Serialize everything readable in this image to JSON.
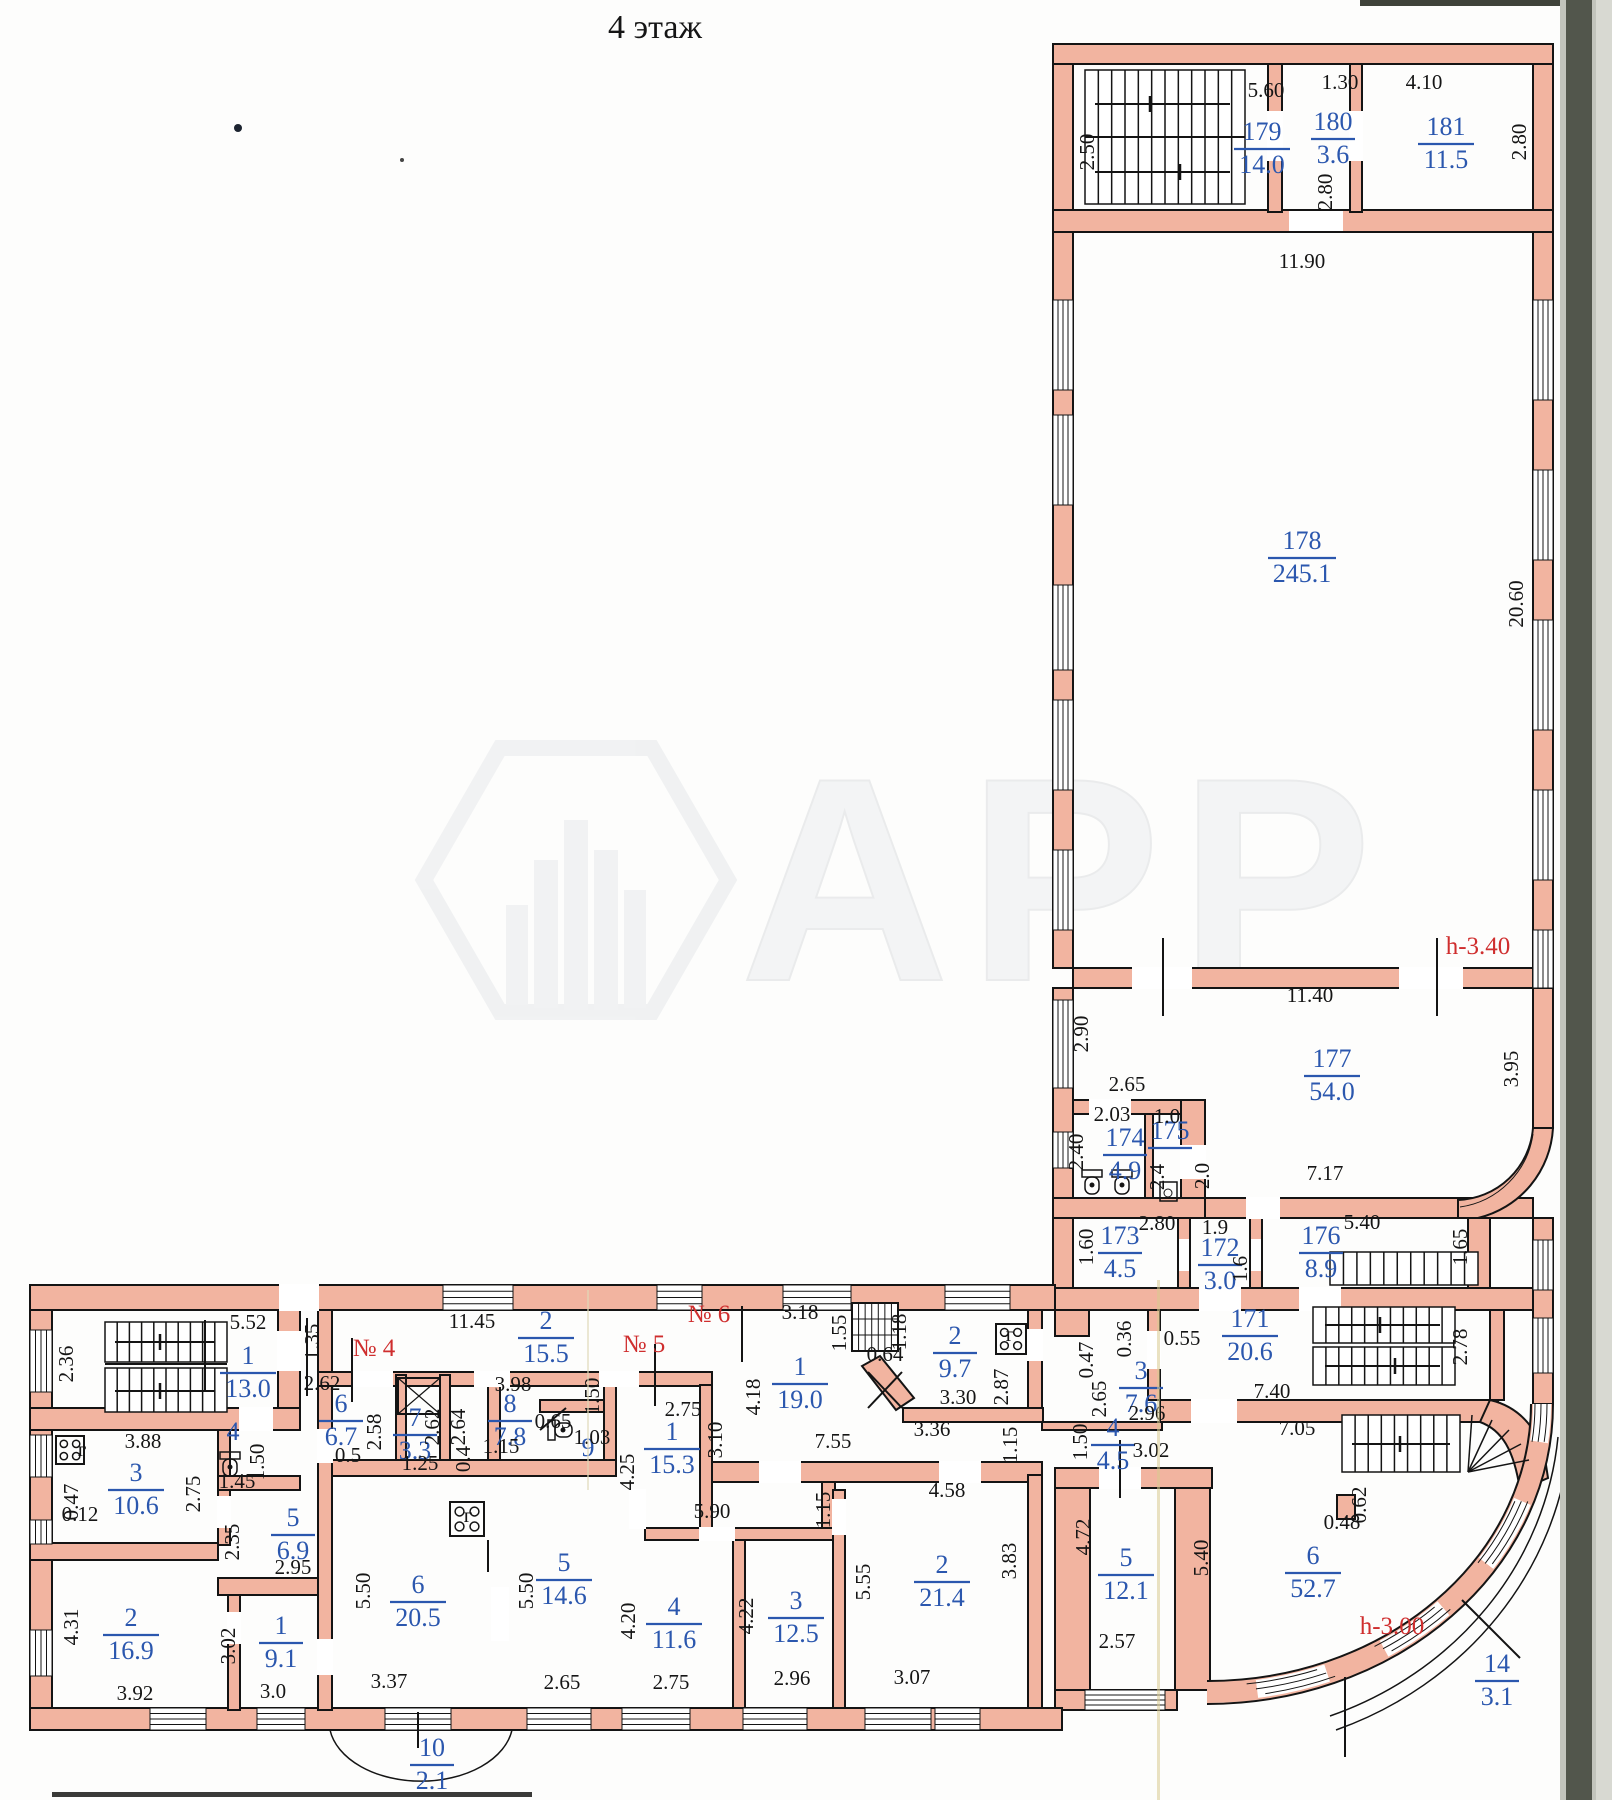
{
  "title": "4    этаж",
  "watermark": "АРР",
  "colors": {
    "wall_pink": "#f2b4a0",
    "wall_pink_light": "#f6c4b2",
    "line_black": "#141414",
    "room_blue": "#2b57ae",
    "annotation_red": "#cf2e2e",
    "scan_band_outer": "#c2c4bc",
    "scan_band_dark": "#52564c",
    "scan_band_edge": "#d8d9d2",
    "crease_yellow": "#d9cb90"
  },
  "rooms": [
    {
      "n": "179",
      "a": "14.0",
      "x": 1262,
      "y": 148
    },
    {
      "n": "180",
      "a": "3.6",
      "x": 1333,
      "y": 138
    },
    {
      "n": "181",
      "a": "11.5",
      "x": 1446,
      "y": 143
    },
    {
      "n": "178",
      "a": "245.1",
      "x": 1302,
      "y": 557
    },
    {
      "n": "177",
      "a": "54.0",
      "x": 1332,
      "y": 1075
    },
    {
      "n": "174",
      "a": "4.9",
      "x": 1125,
      "y": 1154
    },
    {
      "n": "175",
      "a": null,
      "x": 1170,
      "y": 1147
    },
    {
      "n": "173",
      "a": "4.5",
      "x": 1120,
      "y": 1252
    },
    {
      "n": "172",
      "a": "3.0",
      "x": 1220,
      "y": 1264
    },
    {
      "n": "176",
      "a": "8.9",
      "x": 1321,
      "y": 1252
    },
    {
      "n": "171",
      "a": "20.6",
      "x": 1250,
      "y": 1335
    },
    {
      "n": "3",
      "a": "7.6",
      "x": 1141,
      "y": 1387
    },
    {
      "n": "4",
      "a": "4.5",
      "x": 1113,
      "y": 1444
    },
    {
      "n": "1",
      "a": "13.0",
      "x": 248,
      "y": 1372
    },
    {
      "n": "2",
      "a": "15.5",
      "x": 546,
      "y": 1337
    },
    {
      "n": "6",
      "a": "6.7",
      "x": 341,
      "y": 1420
    },
    {
      "n": "7",
      "a": "3.3",
      "x": 415,
      "y": 1434
    },
    {
      "n": "8",
      "a": "7.8",
      "x": 510,
      "y": 1420
    },
    {
      "n": "9",
      "a": null,
      "x": 588,
      "y": 1464,
      "bar": false
    },
    {
      "n": "1",
      "a": "15.3",
      "x": 672,
      "y": 1448
    },
    {
      "n": "1",
      "a": "19.0",
      "x": 800,
      "y": 1383
    },
    {
      "n": "2",
      "a": "9.7",
      "x": 955,
      "y": 1352
    },
    {
      "n": "3",
      "a": "10.6",
      "x": 136,
      "y": 1489
    },
    {
      "n": "4",
      "a": null,
      "x": 233,
      "y": 1448,
      "bar": false
    },
    {
      "n": "5",
      "a": "6.9",
      "x": 293,
      "y": 1534
    },
    {
      "n": "2",
      "a": "16.9",
      "x": 131,
      "y": 1634
    },
    {
      "n": "1",
      "a": "9.1",
      "x": 281,
      "y": 1642
    },
    {
      "n": "6",
      "a": "20.5",
      "x": 418,
      "y": 1601
    },
    {
      "n": "5",
      "a": "14.6",
      "x": 564,
      "y": 1579
    },
    {
      "n": "4",
      "a": "11.6",
      "x": 674,
      "y": 1623
    },
    {
      "n": "3",
      "a": "12.5",
      "x": 796,
      "y": 1617
    },
    {
      "n": "2",
      "a": "21.4",
      "x": 942,
      "y": 1581
    },
    {
      "n": "5",
      "a": "12.1",
      "x": 1126,
      "y": 1574
    },
    {
      "n": "6",
      "a": "52.7",
      "x": 1313,
      "y": 1572
    },
    {
      "n": "10",
      "a": "2.1",
      "x": 432,
      "y": 1764
    },
    {
      "n": "14",
      "a": "3.1",
      "x": 1497,
      "y": 1680
    }
  ],
  "dimensions": [
    [
      "2.50",
      1094,
      152,
      1
    ],
    [
      "5.60",
      1266,
      97,
      0
    ],
    [
      "1.30",
      1340,
      89,
      0
    ],
    [
      "4.10",
      1424,
      89,
      0
    ],
    [
      "2.80",
      1526,
      142,
      1
    ],
    [
      "2.80",
      1332,
      192,
      1
    ],
    [
      "11.90",
      1302,
      268,
      0
    ],
    [
      "20.60",
      1523,
      604,
      1
    ],
    [
      "11.40",
      1310,
      1002,
      0
    ],
    [
      "2.90",
      1088,
      1034,
      1
    ],
    [
      "2.65",
      1127,
      1091,
      0
    ],
    [
      "3.95",
      1518,
      1069,
      1
    ],
    [
      "7.17",
      1325,
      1180,
      0
    ],
    [
      "2.03",
      1112,
      1121,
      0
    ],
    [
      "1.0",
      1167,
      1123,
      0
    ],
    [
      "2.40",
      1083,
      1152,
      1
    ],
    [
      "2.4",
      1164,
      1177,
      1
    ],
    [
      "2.0",
      1209,
      1176,
      1
    ],
    [
      "1.60",
      1093,
      1247,
      1
    ],
    [
      "2.80",
      1157,
      1230,
      0
    ],
    [
      "1.9",
      1215,
      1234,
      0
    ],
    [
      "1.6",
      1247,
      1269,
      1
    ],
    [
      "5.40",
      1362,
      1229,
      0
    ],
    [
      "1.65",
      1467,
      1247,
      1
    ],
    [
      "7.40",
      1272,
      1398,
      0
    ],
    [
      "2.78",
      1467,
      1347,
      1
    ],
    [
      "0.36",
      1131,
      1339,
      1
    ],
    [
      "0.47",
      1093,
      1360,
      1
    ],
    [
      "0.55",
      1182,
      1345,
      0
    ],
    [
      "2.65",
      1106,
      1399,
      1
    ],
    [
      "2.96",
      1147,
      1420,
      0
    ],
    [
      "3.02",
      1151,
      1457,
      0
    ],
    [
      "1.50",
      1087,
      1442,
      1
    ],
    [
      "7.05",
      1297,
      1435,
      0
    ],
    [
      "5.52",
      248,
      1329,
      0
    ],
    [
      "2.36",
      73,
      1364,
      1
    ],
    [
      "1.35",
      319,
      1342,
      1
    ],
    [
      "11.45",
      472,
      1328,
      0
    ],
    [
      "3.18",
      800,
      1319,
      0
    ],
    [
      "1.55",
      846,
      1333,
      1
    ],
    [
      "1.18",
      906,
      1332,
      1
    ],
    [
      "0.64",
      885,
      1361,
      0
    ],
    [
      "2.62",
      322,
      1390,
      0
    ],
    [
      "2.58",
      381,
      1432,
      1
    ],
    [
      "0.5",
      348,
      1462,
      0
    ],
    [
      "2.62",
      439,
      1427,
      1
    ],
    [
      "1.25",
      420,
      1470,
      0
    ],
    [
      "2.64",
      465,
      1427,
      1
    ],
    [
      "3.98",
      513,
      1391,
      0
    ],
    [
      "1.15",
      501,
      1453,
      0
    ],
    [
      "0.4",
      470,
      1459,
      1
    ],
    [
      "0.65",
      553,
      1428,
      0
    ],
    [
      "1.03",
      592,
      1444,
      0
    ],
    [
      "1.50",
      599,
      1396,
      1
    ],
    [
      "2.75",
      683,
      1416,
      0
    ],
    [
      "4.25",
      634,
      1472,
      1
    ],
    [
      "4.18",
      760,
      1397,
      1
    ],
    [
      "3.10",
      722,
      1440,
      1
    ],
    [
      "7.55",
      833,
      1448,
      0
    ],
    [
      "3.36",
      932,
      1436,
      0
    ],
    [
      "2.87",
      1008,
      1387,
      1
    ],
    [
      "3.30",
      958,
      1404,
      0
    ],
    [
      "1.15",
      1017,
      1445,
      1
    ],
    [
      "3.88",
      143,
      1448,
      0
    ],
    [
      "0.47",
      78,
      1502,
      1
    ],
    [
      "0.12",
      80,
      1521,
      0
    ],
    [
      "2.75",
      200,
      1494,
      1
    ],
    [
      "1.50",
      264,
      1462,
      1
    ],
    [
      "1.45",
      237,
      1488,
      0
    ],
    [
      "2.35",
      239,
      1542,
      1
    ],
    [
      "2.95",
      293,
      1574,
      0
    ],
    [
      "4.31",
      78,
      1627,
      1
    ],
    [
      "3.92",
      135,
      1700,
      0
    ],
    [
      "3.02",
      235,
      1646,
      1
    ],
    [
      "3.0",
      273,
      1698,
      0
    ],
    [
      "5.50",
      370,
      1591,
      1
    ],
    [
      "3.37",
      389,
      1688,
      0
    ],
    [
      "5.50",
      533,
      1591,
      1
    ],
    [
      "2.65",
      562,
      1689,
      0
    ],
    [
      "4.20",
      635,
      1621,
      1
    ],
    [
      "2.75",
      671,
      1689,
      0
    ],
    [
      "5.90",
      712,
      1518,
      0
    ],
    [
      "4.22",
      753,
      1616,
      1
    ],
    [
      "2.96",
      792,
      1685,
      0
    ],
    [
      "4.58",
      947,
      1497,
      0
    ],
    [
      "1.15",
      830,
      1510,
      1
    ],
    [
      "5.55",
      870,
      1582,
      1
    ],
    [
      "3.07",
      912,
      1684,
      0
    ],
    [
      "3.83",
      1016,
      1561,
      1
    ],
    [
      "4.72",
      1090,
      1537,
      1
    ],
    [
      "2.57",
      1117,
      1648,
      0
    ],
    [
      "5.40",
      1208,
      1558,
      1
    ],
    [
      "0.48",
      1342,
      1529,
      0
    ],
    [
      "0.62",
      1366,
      1505,
      1
    ],
    [
      "г",
      82,
      1456,
      0
    ],
    [
      "г",
      468,
      1522,
      0
    ],
    [
      "г",
      1010,
      1341,
      0
    ]
  ],
  "annotations": [
    [
      "№ 4",
      374,
      1356
    ],
    [
      "№ 5",
      644,
      1352
    ],
    [
      "№ 6",
      709,
      1322
    ],
    [
      "h-3.40",
      1478,
      954
    ],
    [
      "h-3.00",
      1392,
      1634
    ]
  ]
}
